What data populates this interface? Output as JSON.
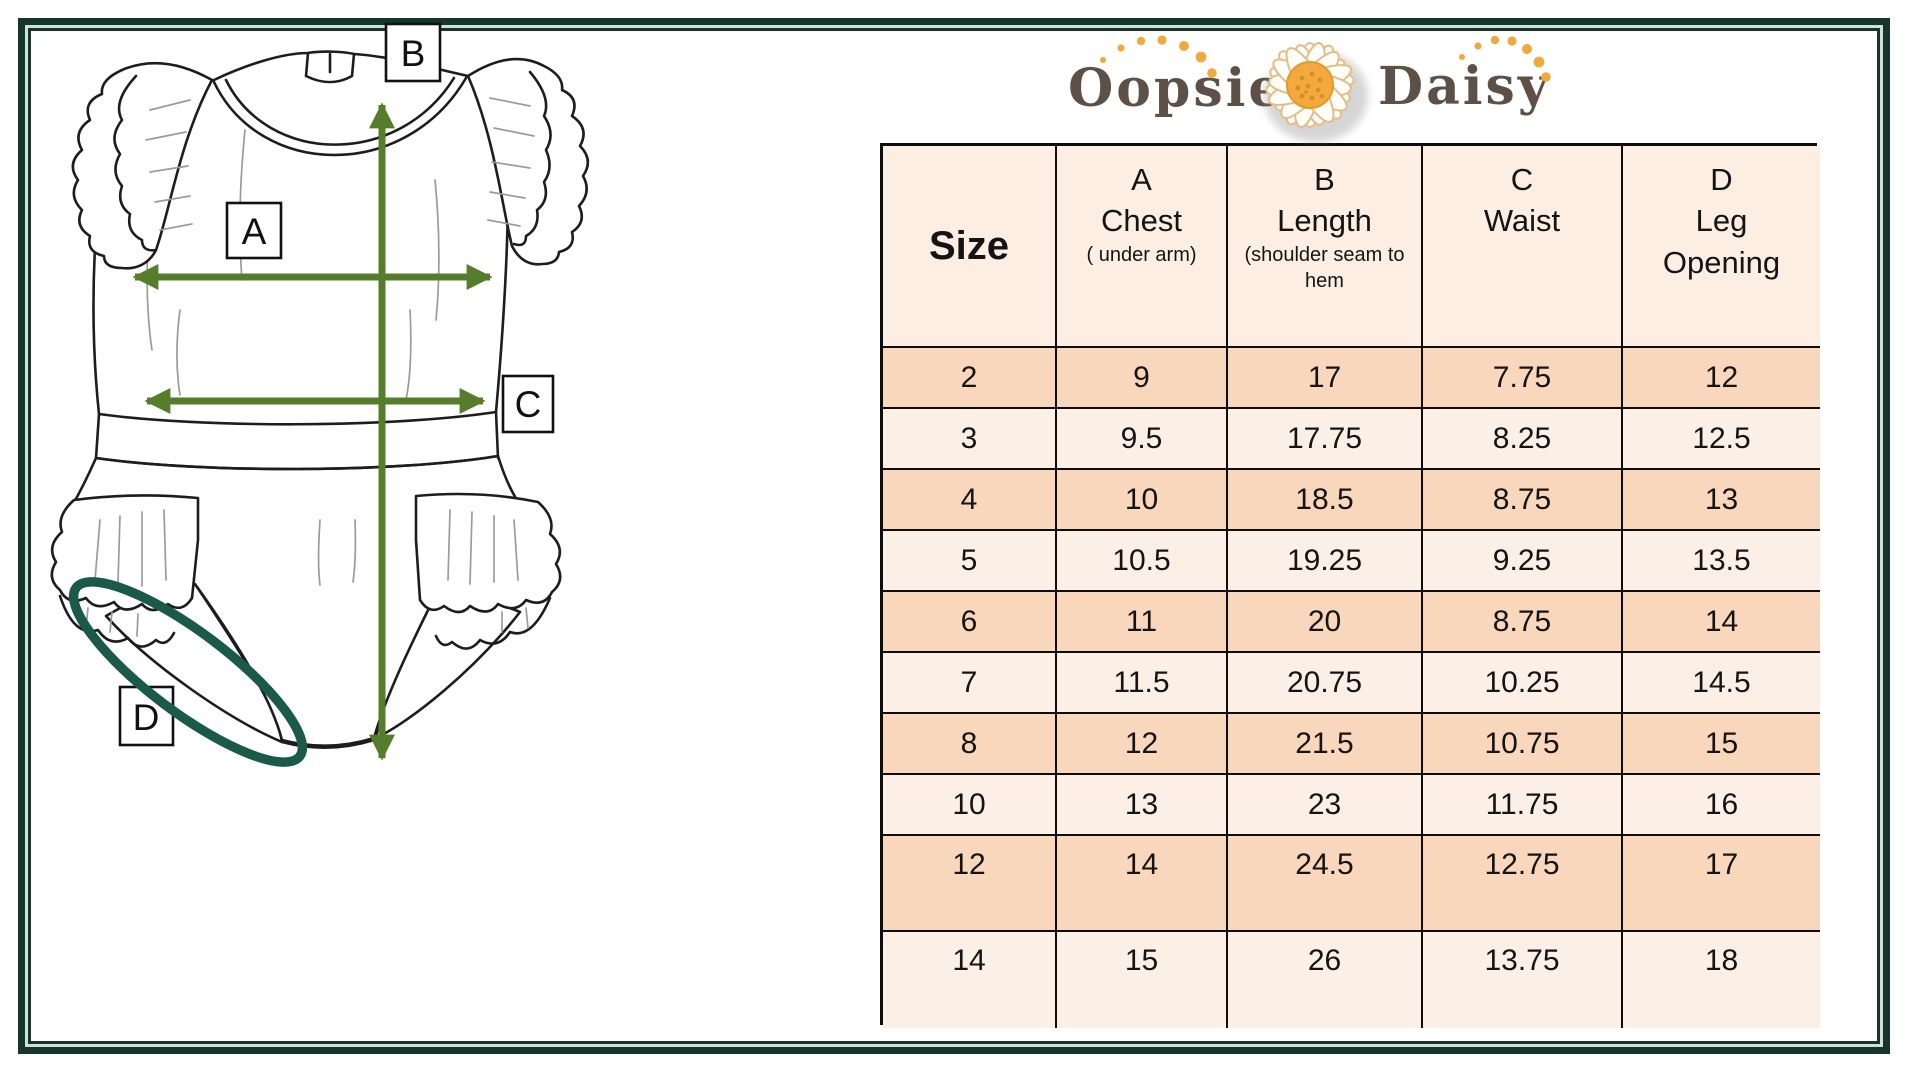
{
  "page": {
    "frame_color": "#16352d",
    "frame_light_line": "#cfe2d4",
    "background": "#ffffff"
  },
  "logo": {
    "word1": "Oopsie",
    "word2": "Daisy",
    "text_color": "#5d5046",
    "dot_color": "#efa93d",
    "daisy_center_color": "#f3a93e",
    "daisy_petal_color": "#ffffff"
  },
  "diagram": {
    "arrow_color": "#567d2c",
    "leg_ellipse_color": "#1b5a47",
    "labels": [
      {
        "letter": "A"
      },
      {
        "letter": "B"
      },
      {
        "letter": "C"
      },
      {
        "letter": "D"
      }
    ]
  },
  "table": {
    "grid_color": "#0d0d0d",
    "header_bg": "#fceee2",
    "row_dark": "#f8d7bd",
    "row_light": "#fcefe6",
    "columns": [
      {
        "id": "size",
        "letter": "",
        "name": "Size",
        "note": ""
      },
      {
        "id": "chest",
        "letter": "A",
        "name": "Chest",
        "note": "( under arm)"
      },
      {
        "id": "length",
        "letter": "B",
        "name": "Length",
        "note": "(shoulder seam to hem"
      },
      {
        "id": "waist",
        "letter": "C",
        "name": "Waist",
        "note": ""
      },
      {
        "id": "leg",
        "letter": "D",
        "name": "Leg\nOpening",
        "note": ""
      }
    ],
    "rows": [
      {
        "size": "2",
        "chest": "9",
        "length": "17",
        "waist": "7.75",
        "leg": "12",
        "shade": "dark"
      },
      {
        "size": "3",
        "chest": "9.5",
        "length": "17.75",
        "waist": "8.25",
        "leg": "12.5",
        "shade": "light"
      },
      {
        "size": "4",
        "chest": "10",
        "length": "18.5",
        "waist": "8.75",
        "leg": "13",
        "shade": "dark"
      },
      {
        "size": "5",
        "chest": "10.5",
        "length": "19.25",
        "waist": "9.25",
        "leg": "13.5",
        "shade": "light"
      },
      {
        "size": "6",
        "chest": "11",
        "length": "20",
        "waist": "8.75",
        "leg": "14",
        "shade": "dark"
      },
      {
        "size": "7",
        "chest": "11.5",
        "length": "20.75",
        "waist": "10.25",
        "leg": "14.5",
        "shade": "light"
      },
      {
        "size": "8",
        "chest": "12",
        "length": "21.5",
        "waist": "10.75",
        "leg": "15",
        "shade": "dark"
      },
      {
        "size": "10",
        "chest": "13",
        "length": "23",
        "waist": "11.75",
        "leg": "16",
        "shade": "light"
      },
      {
        "size": "12",
        "chest": "14",
        "length": "24.5",
        "waist": "12.75",
        "leg": "17",
        "shade": "dark",
        "tall": true
      },
      {
        "size": "14",
        "chest": "15",
        "length": "26",
        "waist": "13.75",
        "leg": "18",
        "shade": "light",
        "tall": true
      }
    ]
  }
}
